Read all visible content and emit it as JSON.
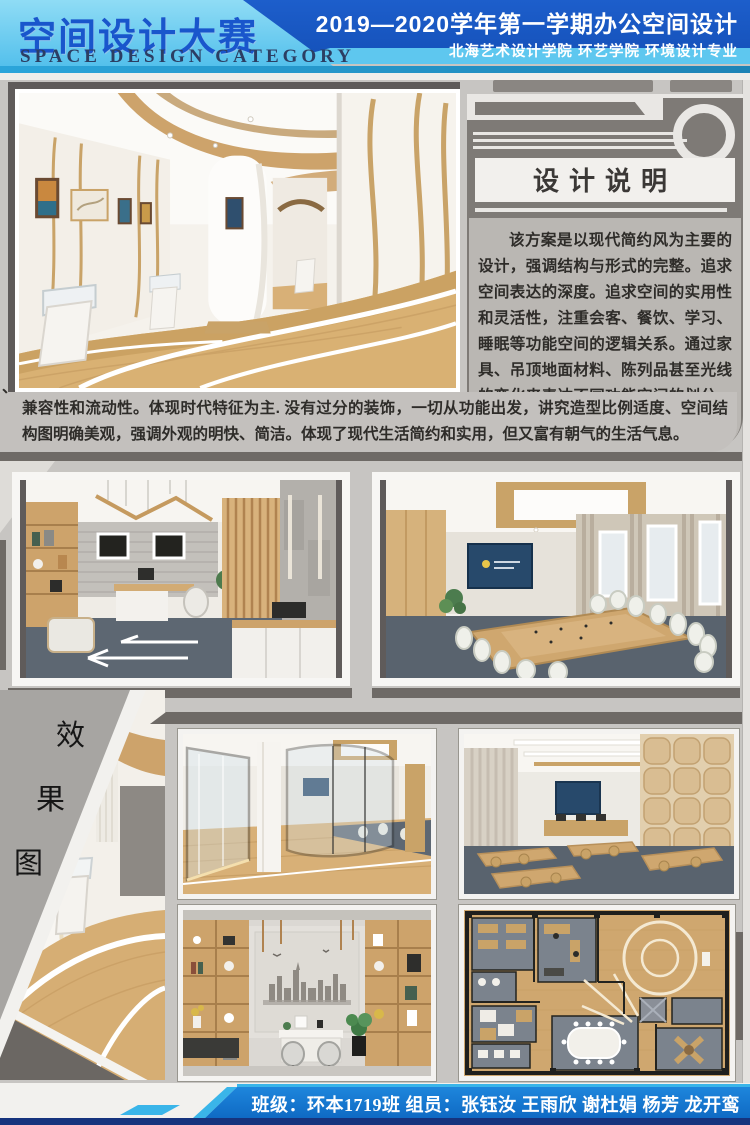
{
  "header": {
    "title_cn": "空间设计大赛",
    "title_en": "SPACE DESIGN CATEGORY",
    "term_line": "2019—2020学年第一学期办公空间设计",
    "school_line": "北海艺术设计学院  环艺学院  环境设计专业"
  },
  "design_notes": {
    "title": "设计说明",
    "paragraph": "该方案是以现代简约风为主要的设计，强调结构与形式的完整。追求空间表达的深度。追求空间的实用性和灵活性，注重会客、餐饮、学习、睡眠等功能空间的逻辑关系。通过家具、吊顶地面材料、陈列品甚至光线的变化来表达不同功能空间的划分，表现出灵活性",
    "continuation": "兼容性和流动性。体现时代特征为主. 没有过分的装饰，一切从功能出发，讲究造型比例适度、空间结构图明确美观，强调外观的明快、简洁。体现了现代生活简约和实用，但又富有朝气的生活气息。",
    "stray_mark": "、"
  },
  "section_label": {
    "chars": [
      "效",
      "果",
      "图"
    ]
  },
  "renderings": [
    "gallery-corridor",
    "office-room",
    "conference-room",
    "curved-corridor",
    "glass-office",
    "training-room",
    "reception-office",
    "floor-plan"
  ],
  "footer": {
    "credits": "班级：环本1719班  组员：张钰汝  王雨欣  谢杜娟  杨芳  龙开鸾"
  },
  "colors": {
    "header_blue": "#1b5ac9",
    "header_cyan": "#63c9f0",
    "title_blue": "#1956cc",
    "body_gray": "#c7c5c2",
    "panel_gray": "#7e7a76",
    "panel_light": "#e9e7e4",
    "textbox_gray": "#bab7b3",
    "rail_gray": "#6e6a66",
    "footer_blue": "#1478d2",
    "footer_cyan": "#3ab5e9",
    "footer_navy": "#16337d"
  }
}
